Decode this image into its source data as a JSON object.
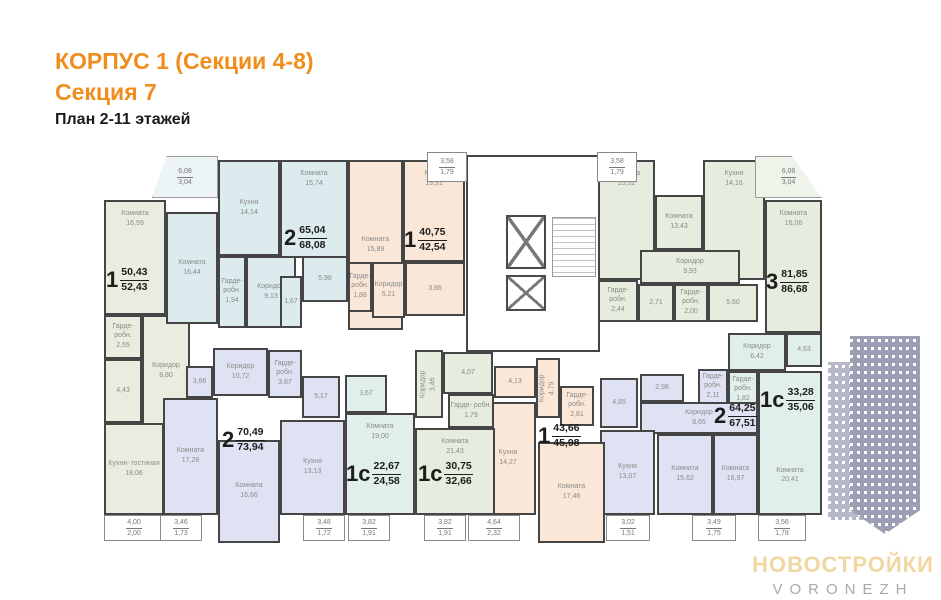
{
  "header": {
    "title_line1": "КОРПУС 1 (Секции 4-8)",
    "title_line2": "Секция 7",
    "subtitle": "План 2-11 этажей"
  },
  "logo": {
    "brand": "НОВОСТРОЙКИ",
    "city": "VORONEZH"
  },
  "palette": {
    "accent": "#ef8d1d",
    "wall": "#454545",
    "sage": "#e9ecdf",
    "blue": "#dcebee",
    "peach": "#fbe7d8",
    "green": "#e6edde",
    "lavender": "#dfe2f3",
    "cyan": "#e0efeb",
    "balcony": "#ffffff",
    "blue_pale": "#ecf4f6",
    "green_pale": "#eff4ea",
    "watermark": "#9da0b5",
    "logo_gold": "#f0d7a2",
    "logo_gray": "#a9a9a9"
  },
  "apartment_labels": [
    {
      "num": "1",
      "top": "50,43",
      "bottom": "52,43",
      "x": 106,
      "y": 266
    },
    {
      "num": "2",
      "top": "65,04",
      "bottom": "68,08",
      "x": 284,
      "y": 224
    },
    {
      "num": "1",
      "top": "40,75",
      "bottom": "42,54",
      "x": 404,
      "y": 226
    },
    {
      "num": "3",
      "top": "81,85",
      "bottom": "86,68",
      "x": 766,
      "y": 268
    },
    {
      "num": "1с",
      "top": "33,28",
      "bottom": "35,06",
      "x": 760,
      "y": 386
    },
    {
      "num": "2",
      "top": "64,25",
      "bottom": "67,51",
      "x": 714,
      "y": 402
    },
    {
      "num": "1",
      "top": "43,66",
      "bottom": "45,98",
      "x": 538,
      "y": 422
    },
    {
      "num": "1с",
      "top": "30,75",
      "bottom": "32,66",
      "x": 418,
      "y": 460
    },
    {
      "num": "1с",
      "top": "22,67",
      "bottom": "24,58",
      "x": 346,
      "y": 460
    },
    {
      "num": "2",
      "top": "70,49",
      "bottom": "73,94",
      "x": 222,
      "y": 426
    }
  ],
  "rooms": [
    {
      "n": "Комната",
      "a": "16,59",
      "x": 104,
      "y": 200,
      "w": 62,
      "h": 115,
      "f": "sage",
      "cl": "va-t"
    },
    {
      "n": "Гарде- робн.",
      "a": "2,55",
      "x": 104,
      "y": 315,
      "w": 38,
      "h": 44,
      "f": "sage"
    },
    {
      "n": "",
      "a": "4,43",
      "x": 104,
      "y": 359,
      "w": 38,
      "h": 64,
      "f": "sage"
    },
    {
      "n": "Коридор",
      "a": "8,80",
      "x": 142,
      "y": 315,
      "w": 48,
      "h": 112,
      "f": "sage"
    },
    {
      "n": "Кухня- гостиная",
      "a": "18,06",
      "x": 104,
      "y": 423,
      "w": 60,
      "h": 92,
      "f": "sage"
    },
    {
      "n": "Комната",
      "a": "16,44",
      "x": 166,
      "y": 212,
      "w": 52,
      "h": 112,
      "f": "blue"
    },
    {
      "n": "Кухня",
      "a": "14,14",
      "x": 218,
      "y": 160,
      "w": 62,
      "h": 96,
      "f": "blue"
    },
    {
      "n": "Комната",
      "a": "15,74",
      "x": 280,
      "y": 160,
      "w": 68,
      "h": 98,
      "f": "blue",
      "cl": "va-t"
    },
    {
      "n": "Гарде- робн.",
      "a": "1,94",
      "x": 218,
      "y": 256,
      "w": 28,
      "h": 72,
      "f": "blue"
    },
    {
      "n": "Коридор",
      "a": "9,13",
      "x": 246,
      "y": 256,
      "w": 50,
      "h": 72,
      "f": "blue"
    },
    {
      "n": "",
      "a": "1,67",
      "x": 280,
      "y": 276,
      "w": 22,
      "h": 52,
      "f": "blue"
    },
    {
      "n": "",
      "a": "5,98",
      "x": 302,
      "y": 256,
      "w": 46,
      "h": 46,
      "f": "blue"
    },
    {
      "n": "Комната",
      "a": "15,89",
      "x": 348,
      "y": 160,
      "w": 55,
      "h": 170,
      "f": "peach"
    },
    {
      "n": "Кухня",
      "a": "13,91",
      "x": 403,
      "y": 160,
      "w": 62,
      "h": 102,
      "f": "peach",
      "cl": "va-t"
    },
    {
      "n": "Гарде- робн.",
      "a": "1,88",
      "x": 348,
      "y": 262,
      "w": 24,
      "h": 50,
      "f": "peach"
    },
    {
      "n": "Коридор",
      "a": "5,21",
      "x": 372,
      "y": 262,
      "w": 33,
      "h": 56,
      "f": "peach"
    },
    {
      "n": "",
      "a": "3,86",
      "x": 405,
      "y": 262,
      "w": 60,
      "h": 54,
      "f": "peach"
    },
    {
      "n": "Комната",
      "a": "15,52",
      "x": 598,
      "y": 160,
      "w": 57,
      "h": 120,
      "f": "green",
      "cl": "va-t"
    },
    {
      "n": "Комната",
      "a": "13,43",
      "x": 655,
      "y": 195,
      "w": 48,
      "h": 55,
      "f": "green"
    },
    {
      "n": "Кухня",
      "a": "14,16",
      "x": 703,
      "y": 160,
      "w": 62,
      "h": 120,
      "f": "green",
      "cl": "va-t"
    },
    {
      "n": "Комната",
      "a": "16,06",
      "x": 765,
      "y": 200,
      "w": 57,
      "h": 133,
      "f": "green",
      "cl": "va-t"
    },
    {
      "n": "Коридор",
      "a": "9,93",
      "x": 640,
      "y": 250,
      "w": 100,
      "h": 34,
      "f": "green"
    },
    {
      "n": "Гарде- робн.",
      "a": "2,44",
      "x": 598,
      "y": 280,
      "w": 40,
      "h": 42,
      "f": "green"
    },
    {
      "n": "",
      "a": "2,71",
      "x": 638,
      "y": 284,
      "w": 36,
      "h": 38,
      "f": "green"
    },
    {
      "n": "Гарде- робн.",
      "a": "2,00",
      "x": 674,
      "y": 284,
      "w": 34,
      "h": 38,
      "f": "green"
    },
    {
      "n": "",
      "a": "5,60",
      "x": 708,
      "y": 284,
      "w": 50,
      "h": 38,
      "f": "green"
    },
    {
      "n": "Коридор",
      "a": "6,42",
      "x": 728,
      "y": 333,
      "w": 58,
      "h": 38,
      "f": "cyan"
    },
    {
      "n": "",
      "a": "4,63",
      "x": 786,
      "y": 333,
      "w": 36,
      "h": 34,
      "f": "cyan"
    },
    {
      "n": "Гарде- робн.",
      "a": "1,82",
      "x": 728,
      "y": 371,
      "w": 30,
      "h": 38,
      "f": "cyan"
    },
    {
      "n": "Комната",
      "a": "20,41",
      "x": 758,
      "y": 371,
      "w": 64,
      "h": 144,
      "f": "cyan",
      "cl": "va-b"
    },
    {
      "n": "Гарде- робн.",
      "a": "2,11",
      "x": 698,
      "y": 369,
      "w": 30,
      "h": 36,
      "f": "lavender"
    },
    {
      "n": "",
      "a": "2,98",
      "x": 640,
      "y": 374,
      "w": 44,
      "h": 28,
      "f": "lavender"
    },
    {
      "n": "",
      "a": "4,85",
      "x": 600,
      "y": 378,
      "w": 38,
      "h": 50,
      "f": "lavender"
    },
    {
      "n": "Коридор",
      "a": "8,65",
      "x": 640,
      "y": 402,
      "w": 118,
      "h": 32,
      "f": "lavender"
    },
    {
      "n": "Кухня",
      "a": "13,07",
      "x": 600,
      "y": 430,
      "w": 55,
      "h": 85,
      "f": "lavender"
    },
    {
      "n": "Комната",
      "a": "15,62",
      "x": 657,
      "y": 434,
      "w": 56,
      "h": 81,
      "f": "lavender"
    },
    {
      "n": "Комната",
      "a": "16,97",
      "x": 713,
      "y": 434,
      "w": 45,
      "h": 81,
      "f": "lavender"
    },
    {
      "n": "",
      "a": "4,13",
      "x": 494,
      "y": 366,
      "w": 42,
      "h": 32,
      "f": "peach"
    },
    {
      "n": "Коридор",
      "a": "4,79",
      "x": 536,
      "y": 358,
      "w": 24,
      "h": 60,
      "f": "peach",
      "rot": true
    },
    {
      "n": "Гарде- робн.",
      "a": "2,81",
      "x": 560,
      "y": 386,
      "w": 34,
      "h": 40,
      "f": "peach"
    },
    {
      "n": "Кухня",
      "a": "14,27",
      "x": 480,
      "y": 402,
      "w": 56,
      "h": 113,
      "f": "peach"
    },
    {
      "n": "Комната",
      "a": "17,46",
      "x": 538,
      "y": 442,
      "w": 67,
      "h": 101,
      "f": "peach"
    },
    {
      "n": "Коридор",
      "a": "3,46",
      "x": 415,
      "y": 350,
      "w": 28,
      "h": 68,
      "f": "green",
      "rot": true
    },
    {
      "n": "",
      "a": "4,07",
      "x": 443,
      "y": 352,
      "w": 50,
      "h": 42,
      "f": "green"
    },
    {
      "n": "Гарде- робн.",
      "a": "1,79",
      "x": 448,
      "y": 394,
      "w": 46,
      "h": 34,
      "f": "green"
    },
    {
      "n": "Комната",
      "a": "21,43",
      "x": 415,
      "y": 428,
      "w": 80,
      "h": 87,
      "f": "green",
      "cl": "va-t"
    },
    {
      "n": "",
      "a": "3,67",
      "x": 345,
      "y": 375,
      "w": 42,
      "h": 38,
      "f": "cyan"
    },
    {
      "n": "Комната",
      "a": "19,00",
      "x": 345,
      "y": 413,
      "w": 70,
      "h": 102,
      "f": "cyan",
      "cl": "va-t"
    },
    {
      "n": "Коридор",
      "a": "10,72",
      "x": 213,
      "y": 348,
      "w": 55,
      "h": 48,
      "f": "lavender"
    },
    {
      "n": "",
      "a": "3,66",
      "x": 186,
      "y": 366,
      "w": 27,
      "h": 32,
      "f": "lavender"
    },
    {
      "n": "Гарде- робн.",
      "a": "3,87",
      "x": 268,
      "y": 350,
      "w": 34,
      "h": 48,
      "f": "lavender"
    },
    {
      "n": "",
      "a": "5,17",
      "x": 302,
      "y": 376,
      "w": 38,
      "h": 42,
      "f": "lavender"
    },
    {
      "n": "Комната",
      "a": "17,28",
      "x": 163,
      "y": 398,
      "w": 55,
      "h": 117,
      "f": "lavender"
    },
    {
      "n": "Комната",
      "a": "16,66",
      "x": 218,
      "y": 440,
      "w": 62,
      "h": 103,
      "f": "lavender"
    },
    {
      "n": "Кухня",
      "a": "13,13",
      "x": 280,
      "y": 420,
      "w": 65,
      "h": 95,
      "f": "lavender"
    }
  ],
  "balconies": [
    {
      "t": "6,08",
      "b": "3,04",
      "x": 152,
      "y": 156,
      "w": 66,
      "h": 42,
      "f": "blue_pale",
      "clip": "tl"
    },
    {
      "t": "3,58",
      "b": "1,79",
      "x": 427,
      "y": 152,
      "w": 40,
      "h": 30,
      "f": "balcony"
    },
    {
      "t": "3,58",
      "b": "1,79",
      "x": 597,
      "y": 152,
      "w": 40,
      "h": 30,
      "f": "balcony"
    },
    {
      "t": "6,08",
      "b": "3,04",
      "x": 755,
      "y": 156,
      "w": 67,
      "h": 42,
      "f": "green_pale",
      "clip": "tr"
    },
    {
      "t": "4,00",
      "b": "2,00",
      "x": 104,
      "y": 515,
      "w": 60,
      "h": 26,
      "f": "balcony"
    },
    {
      "t": "3,46",
      "b": "1,73",
      "x": 160,
      "y": 515,
      "w": 42,
      "h": 26,
      "f": "balcony"
    },
    {
      "t": "3,48",
      "b": "1,72",
      "x": 303,
      "y": 515,
      "w": 42,
      "h": 26,
      "f": "balcony"
    },
    {
      "t": "3,82",
      "b": "1,91",
      "x": 348,
      "y": 515,
      "w": 42,
      "h": 26,
      "f": "balcony"
    },
    {
      "t": "3,82",
      "b": "1,91",
      "x": 424,
      "y": 515,
      "w": 42,
      "h": 26,
      "f": "balcony"
    },
    {
      "t": "4,64",
      "b": "2,32",
      "x": 468,
      "y": 515,
      "w": 52,
      "h": 26,
      "f": "balcony"
    },
    {
      "t": "3,02",
      "b": "1,51",
      "x": 606,
      "y": 515,
      "w": 44,
      "h": 26,
      "f": "balcony"
    },
    {
      "t": "3,49",
      "b": "1,75",
      "x": 692,
      "y": 515,
      "w": 44,
      "h": 26,
      "f": "balcony"
    },
    {
      "t": "3,56",
      "b": "1,78",
      "x": 758,
      "y": 515,
      "w": 48,
      "h": 26,
      "f": "balcony"
    }
  ]
}
